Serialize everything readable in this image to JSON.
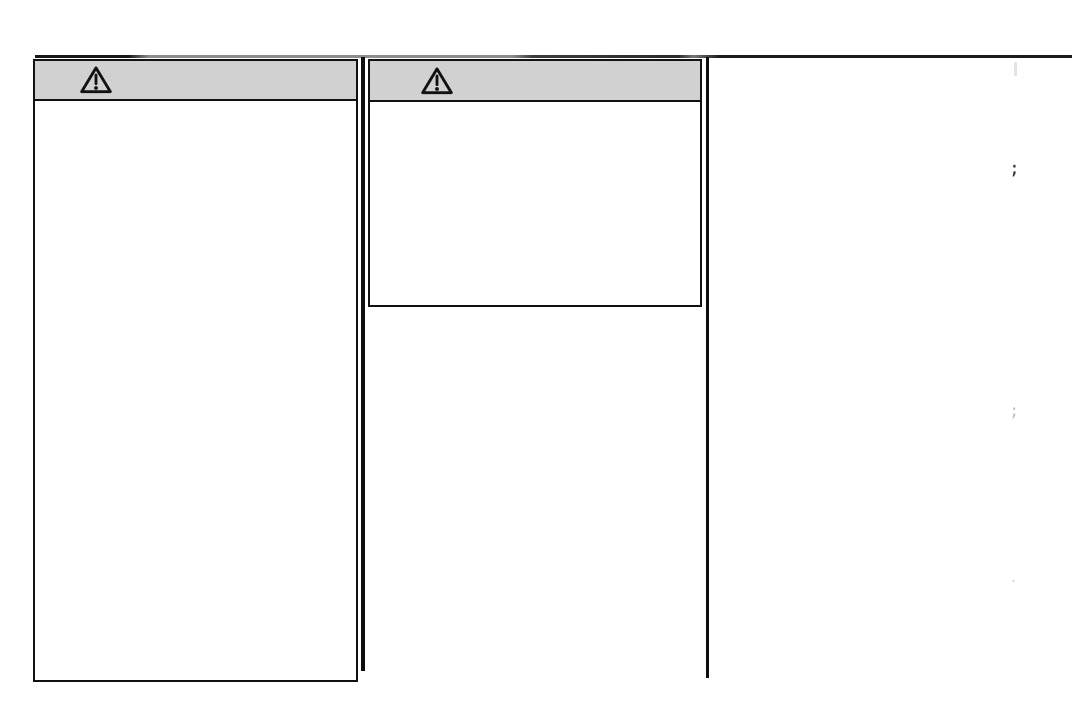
{
  "page": {
    "background": "#ffffff"
  },
  "colors": {
    "page-bg": "#ffffff",
    "header-bg": "#d1d1d1",
    "box-border": "#111111"
  },
  "boxes": [
    {
      "name": "warning-box-left",
      "icon": "warning-triangle-icon",
      "header_text": "",
      "body_text": ""
    },
    {
      "name": "warning-box-middle",
      "icon": "warning-triangle-icon",
      "header_text": "",
      "body_text": ""
    }
  ],
  "artifacts": {
    "fragment_top": ";",
    "fragment_middle": ";",
    "fragment_bottom": "."
  }
}
